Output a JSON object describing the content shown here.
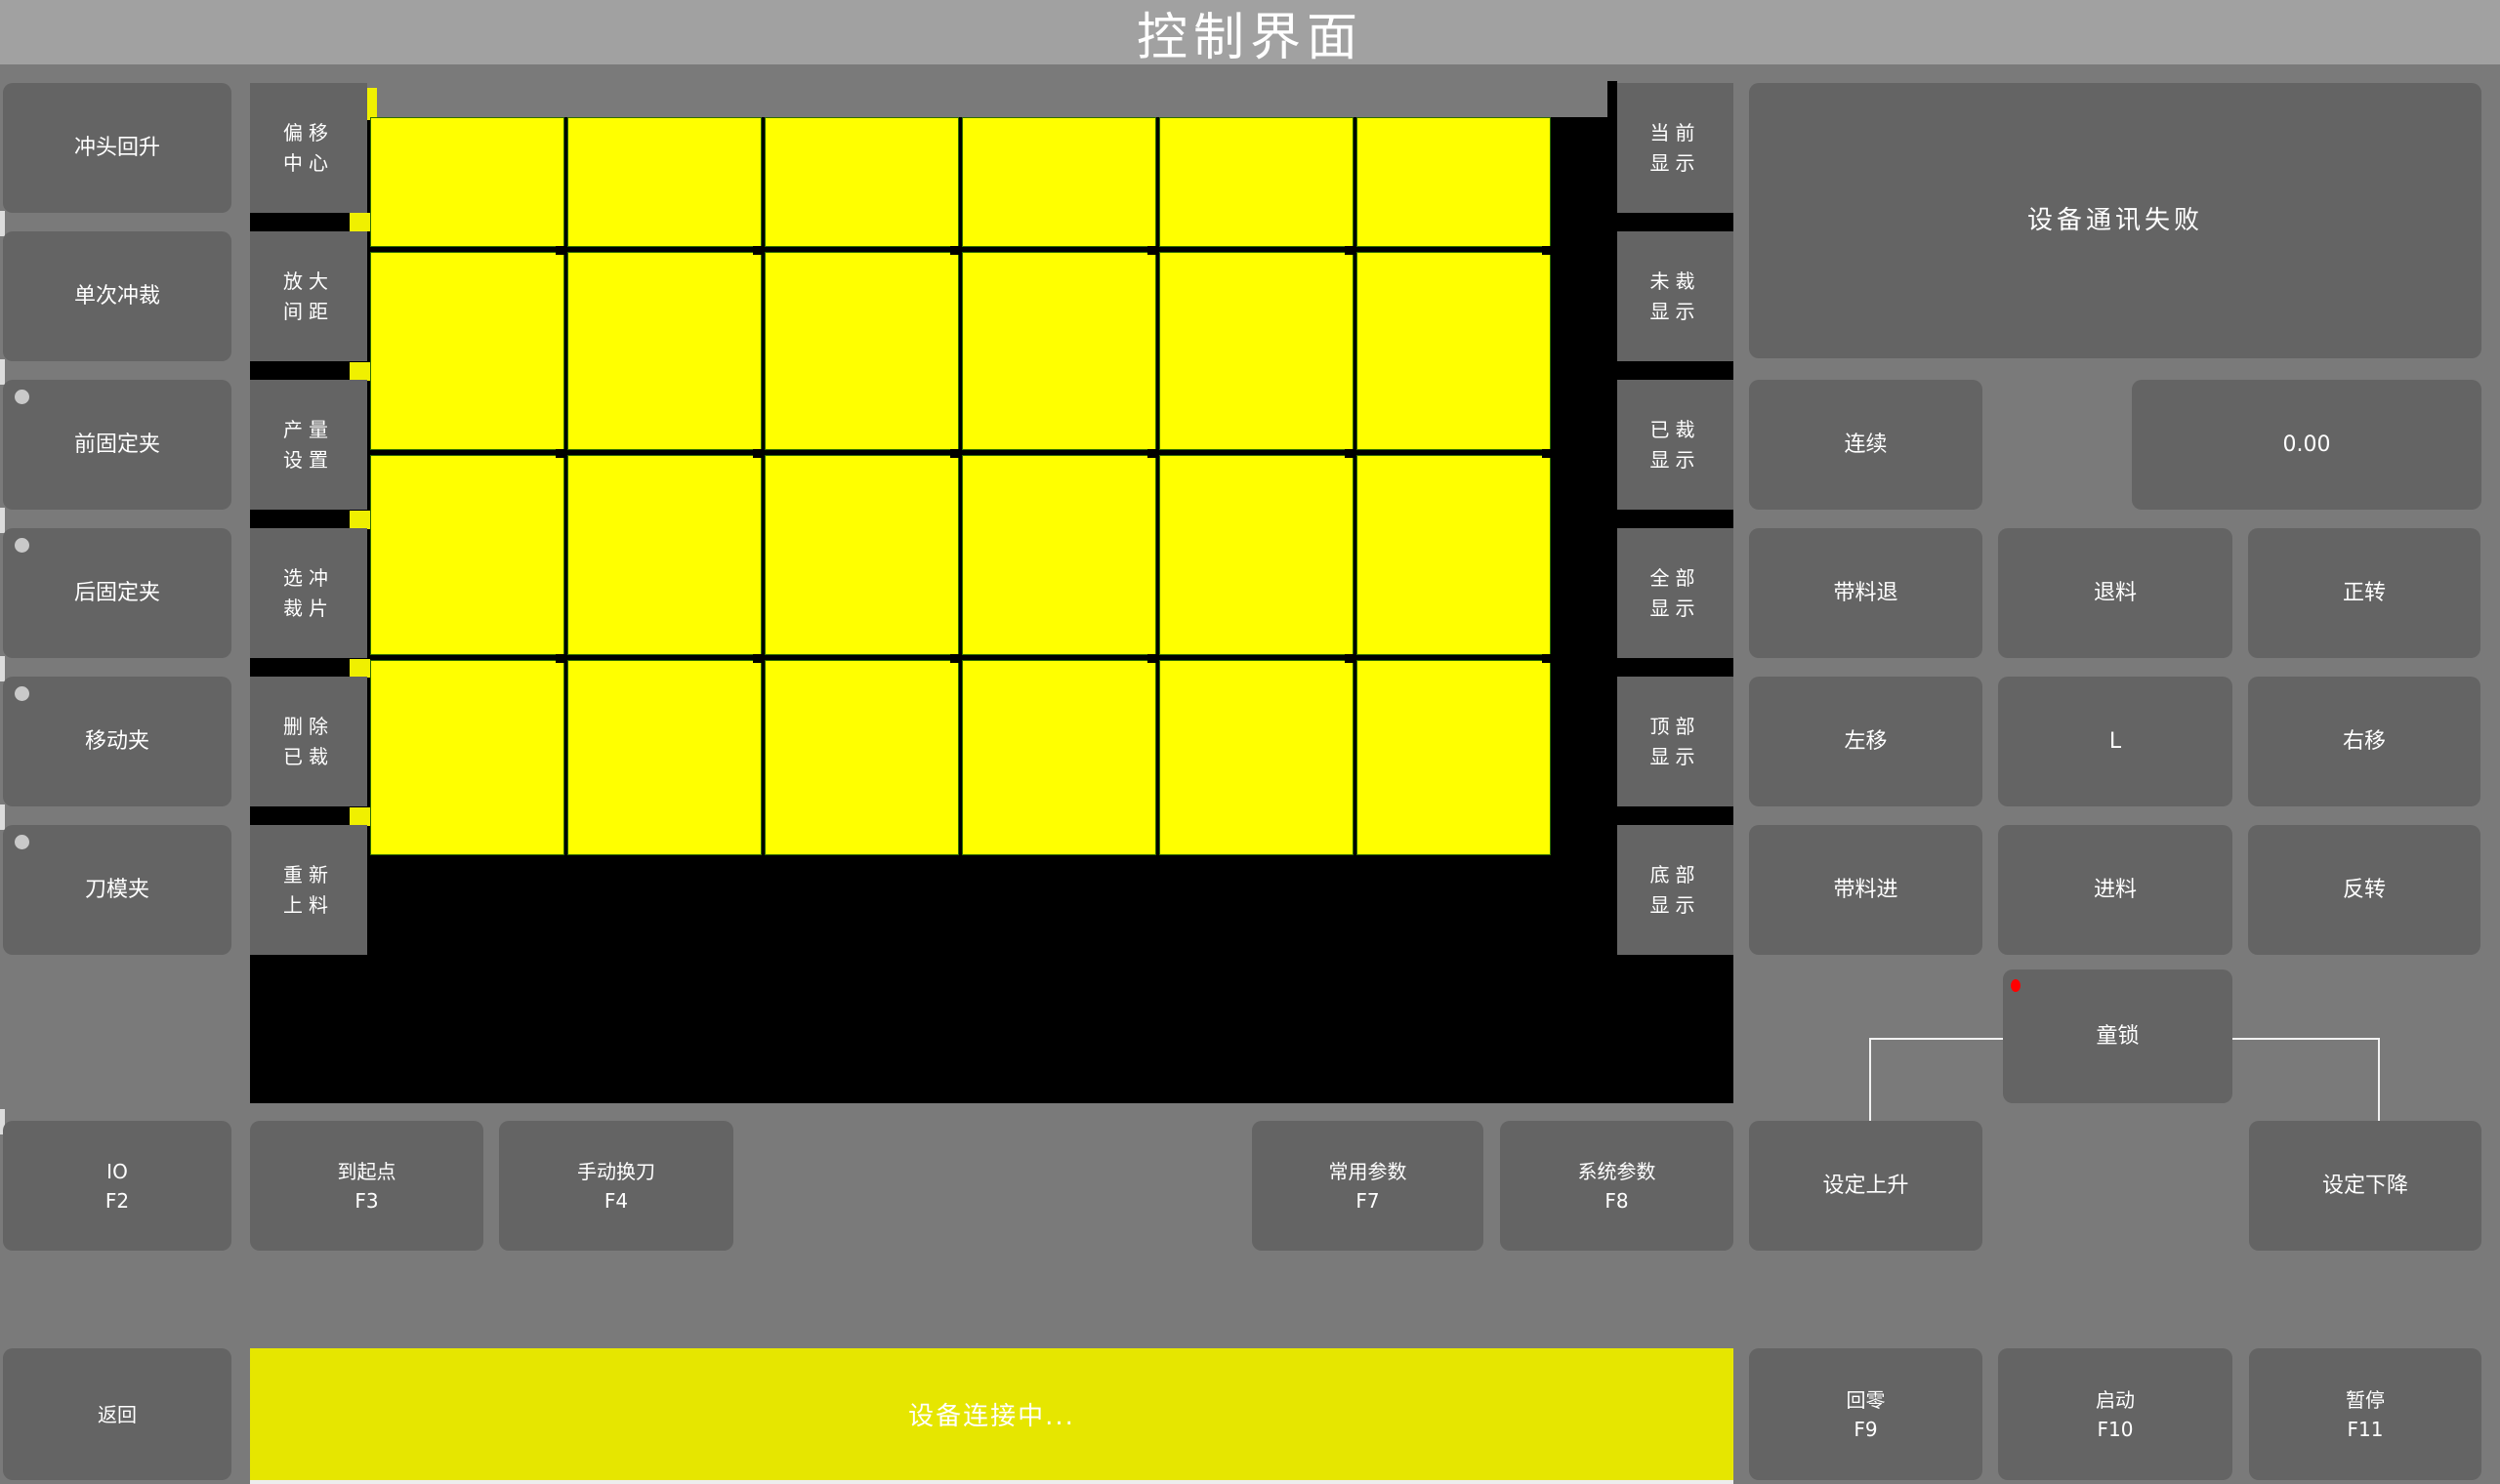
{
  "title_bar": {
    "title": "控制界面"
  },
  "left_panel": {
    "buttons": [
      {
        "label": "冲头回升",
        "dot": false
      },
      {
        "label": "单次冲裁",
        "dot": false
      },
      {
        "label": "前固定夹",
        "dot": true
      },
      {
        "label": "后固定夹",
        "dot": true
      },
      {
        "label": "移动夹",
        "dot": true
      },
      {
        "label": "刀模夹",
        "dot": true
      }
    ]
  },
  "tool_panel": {
    "buttons": [
      {
        "label": "偏移中心"
      },
      {
        "label": "放大间距"
      },
      {
        "label": "产量设置"
      },
      {
        "label": "选冲裁片"
      },
      {
        "label": "删除已裁"
      },
      {
        "label": "重新上料"
      }
    ]
  },
  "display_panel": {
    "buttons": [
      {
        "label": "当前显示"
      },
      {
        "label": "未裁显示"
      },
      {
        "label": "已裁显示"
      },
      {
        "label": "全部显示"
      },
      {
        "label": "顶部显示"
      },
      {
        "label": "底部显示"
      }
    ]
  },
  "viewer": {
    "rows": 4,
    "cols": 6,
    "piece_color": "#ffff00",
    "piece_border": "#2e6b00",
    "background": "#000000"
  },
  "right_panel": {
    "alarm_text": "设备通讯失败",
    "mode_button": "连续",
    "value_display": "0.00",
    "jog_buttons": [
      "带料退",
      "退料",
      "正转",
      "左移",
      "L",
      "右移",
      "带料进",
      "进料",
      "反转"
    ],
    "child_lock_button": "童锁",
    "set_rise_button": "设定上升",
    "set_fall_button": "设定下降"
  },
  "function_row": {
    "buttons": [
      {
        "label": "IO",
        "fkey": "F2"
      },
      {
        "label": "到起点",
        "fkey": "F3"
      },
      {
        "label": "手动换刀",
        "fkey": "F4"
      },
      {
        "label": "常用参数",
        "fkey": "F7"
      },
      {
        "label": "系统参数",
        "fkey": "F8"
      }
    ]
  },
  "bottom_bar": {
    "back_button": "返回",
    "status_text": "设备连接中...",
    "fkey_buttons": [
      {
        "label": "回零",
        "fkey": "F9"
      },
      {
        "label": "启动",
        "fkey": "F10"
      },
      {
        "label": "暂停",
        "fkey": "F11"
      }
    ]
  },
  "colors": {
    "page_bg": "#7a7a7a",
    "title_bar_bg": "#a1a1a1",
    "button_bg": "#646464",
    "piece_yellow": "#ffff00",
    "piece_border_green": "#2e6b00",
    "status_bar_yellow": "#e6e600",
    "indicator_red": "#ff0000",
    "indicator_gray": "#c9c9c9"
  }
}
